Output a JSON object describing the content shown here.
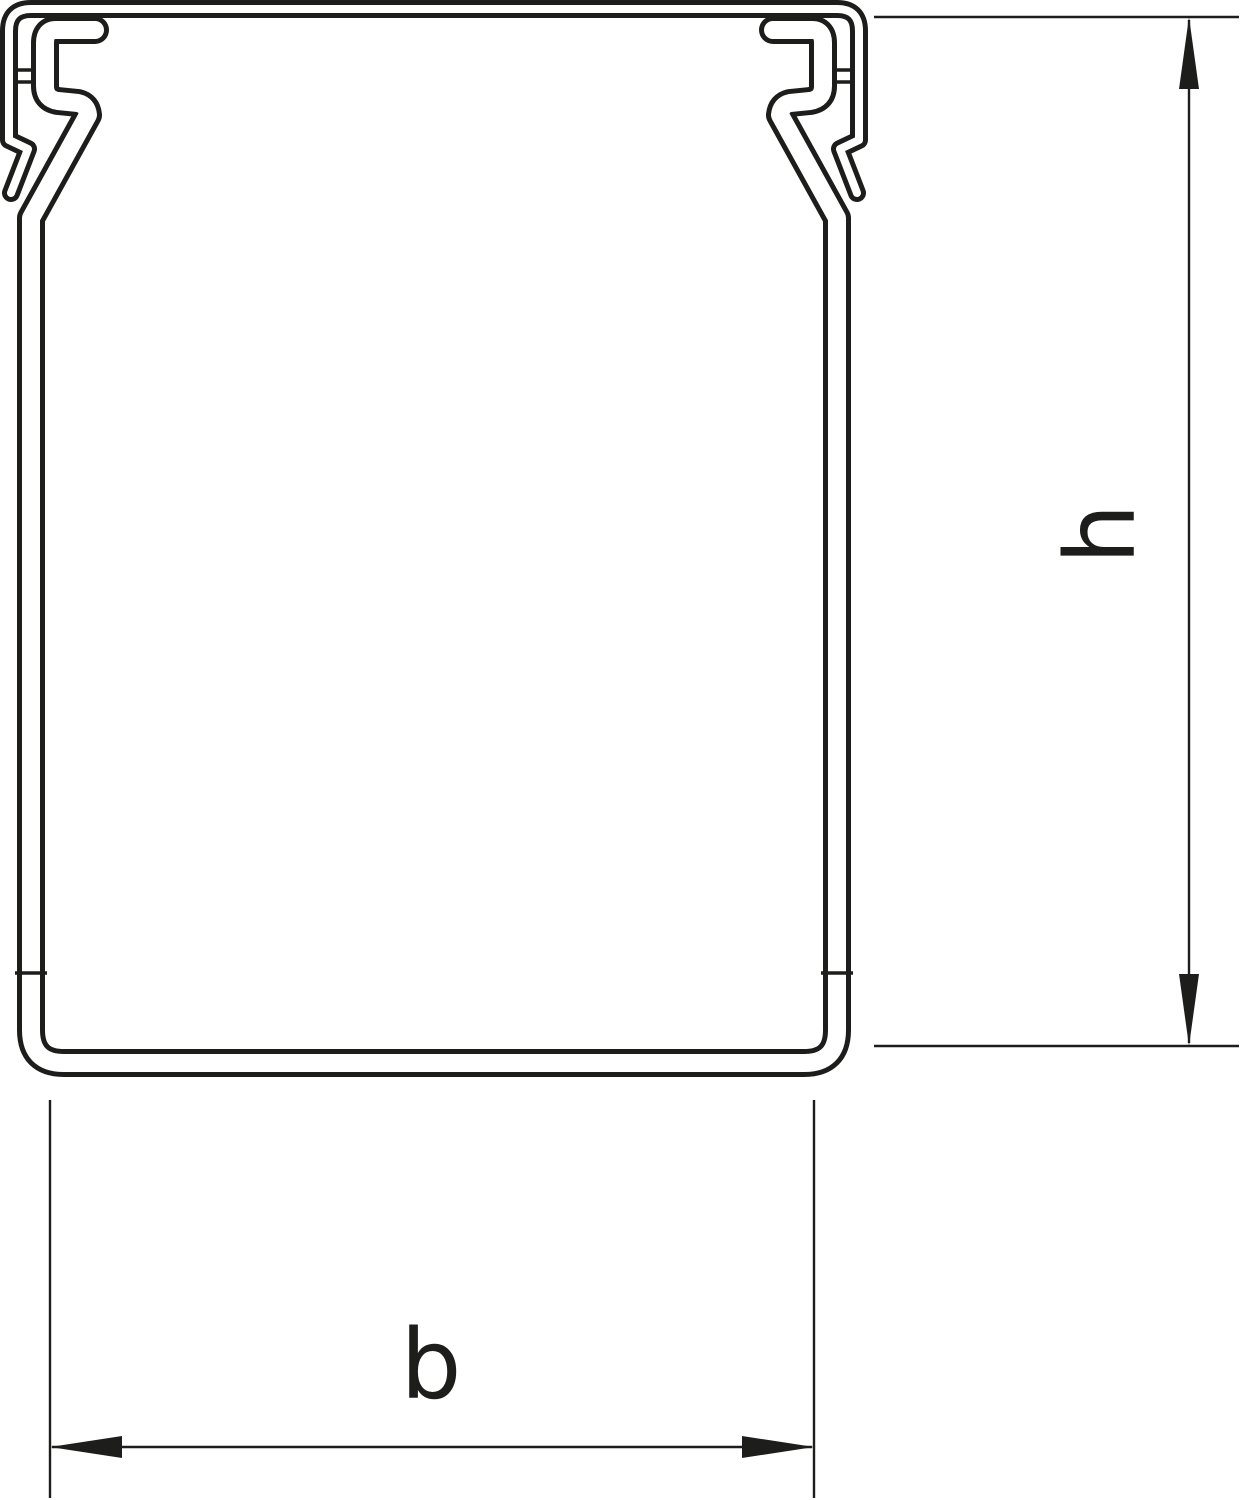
{
  "drawing": {
    "background_color": "#ffffff",
    "line_color": "#1d1d1b",
    "dimensions": {
      "height": {
        "label": "h"
      },
      "width": {
        "label": "b"
      }
    }
  }
}
